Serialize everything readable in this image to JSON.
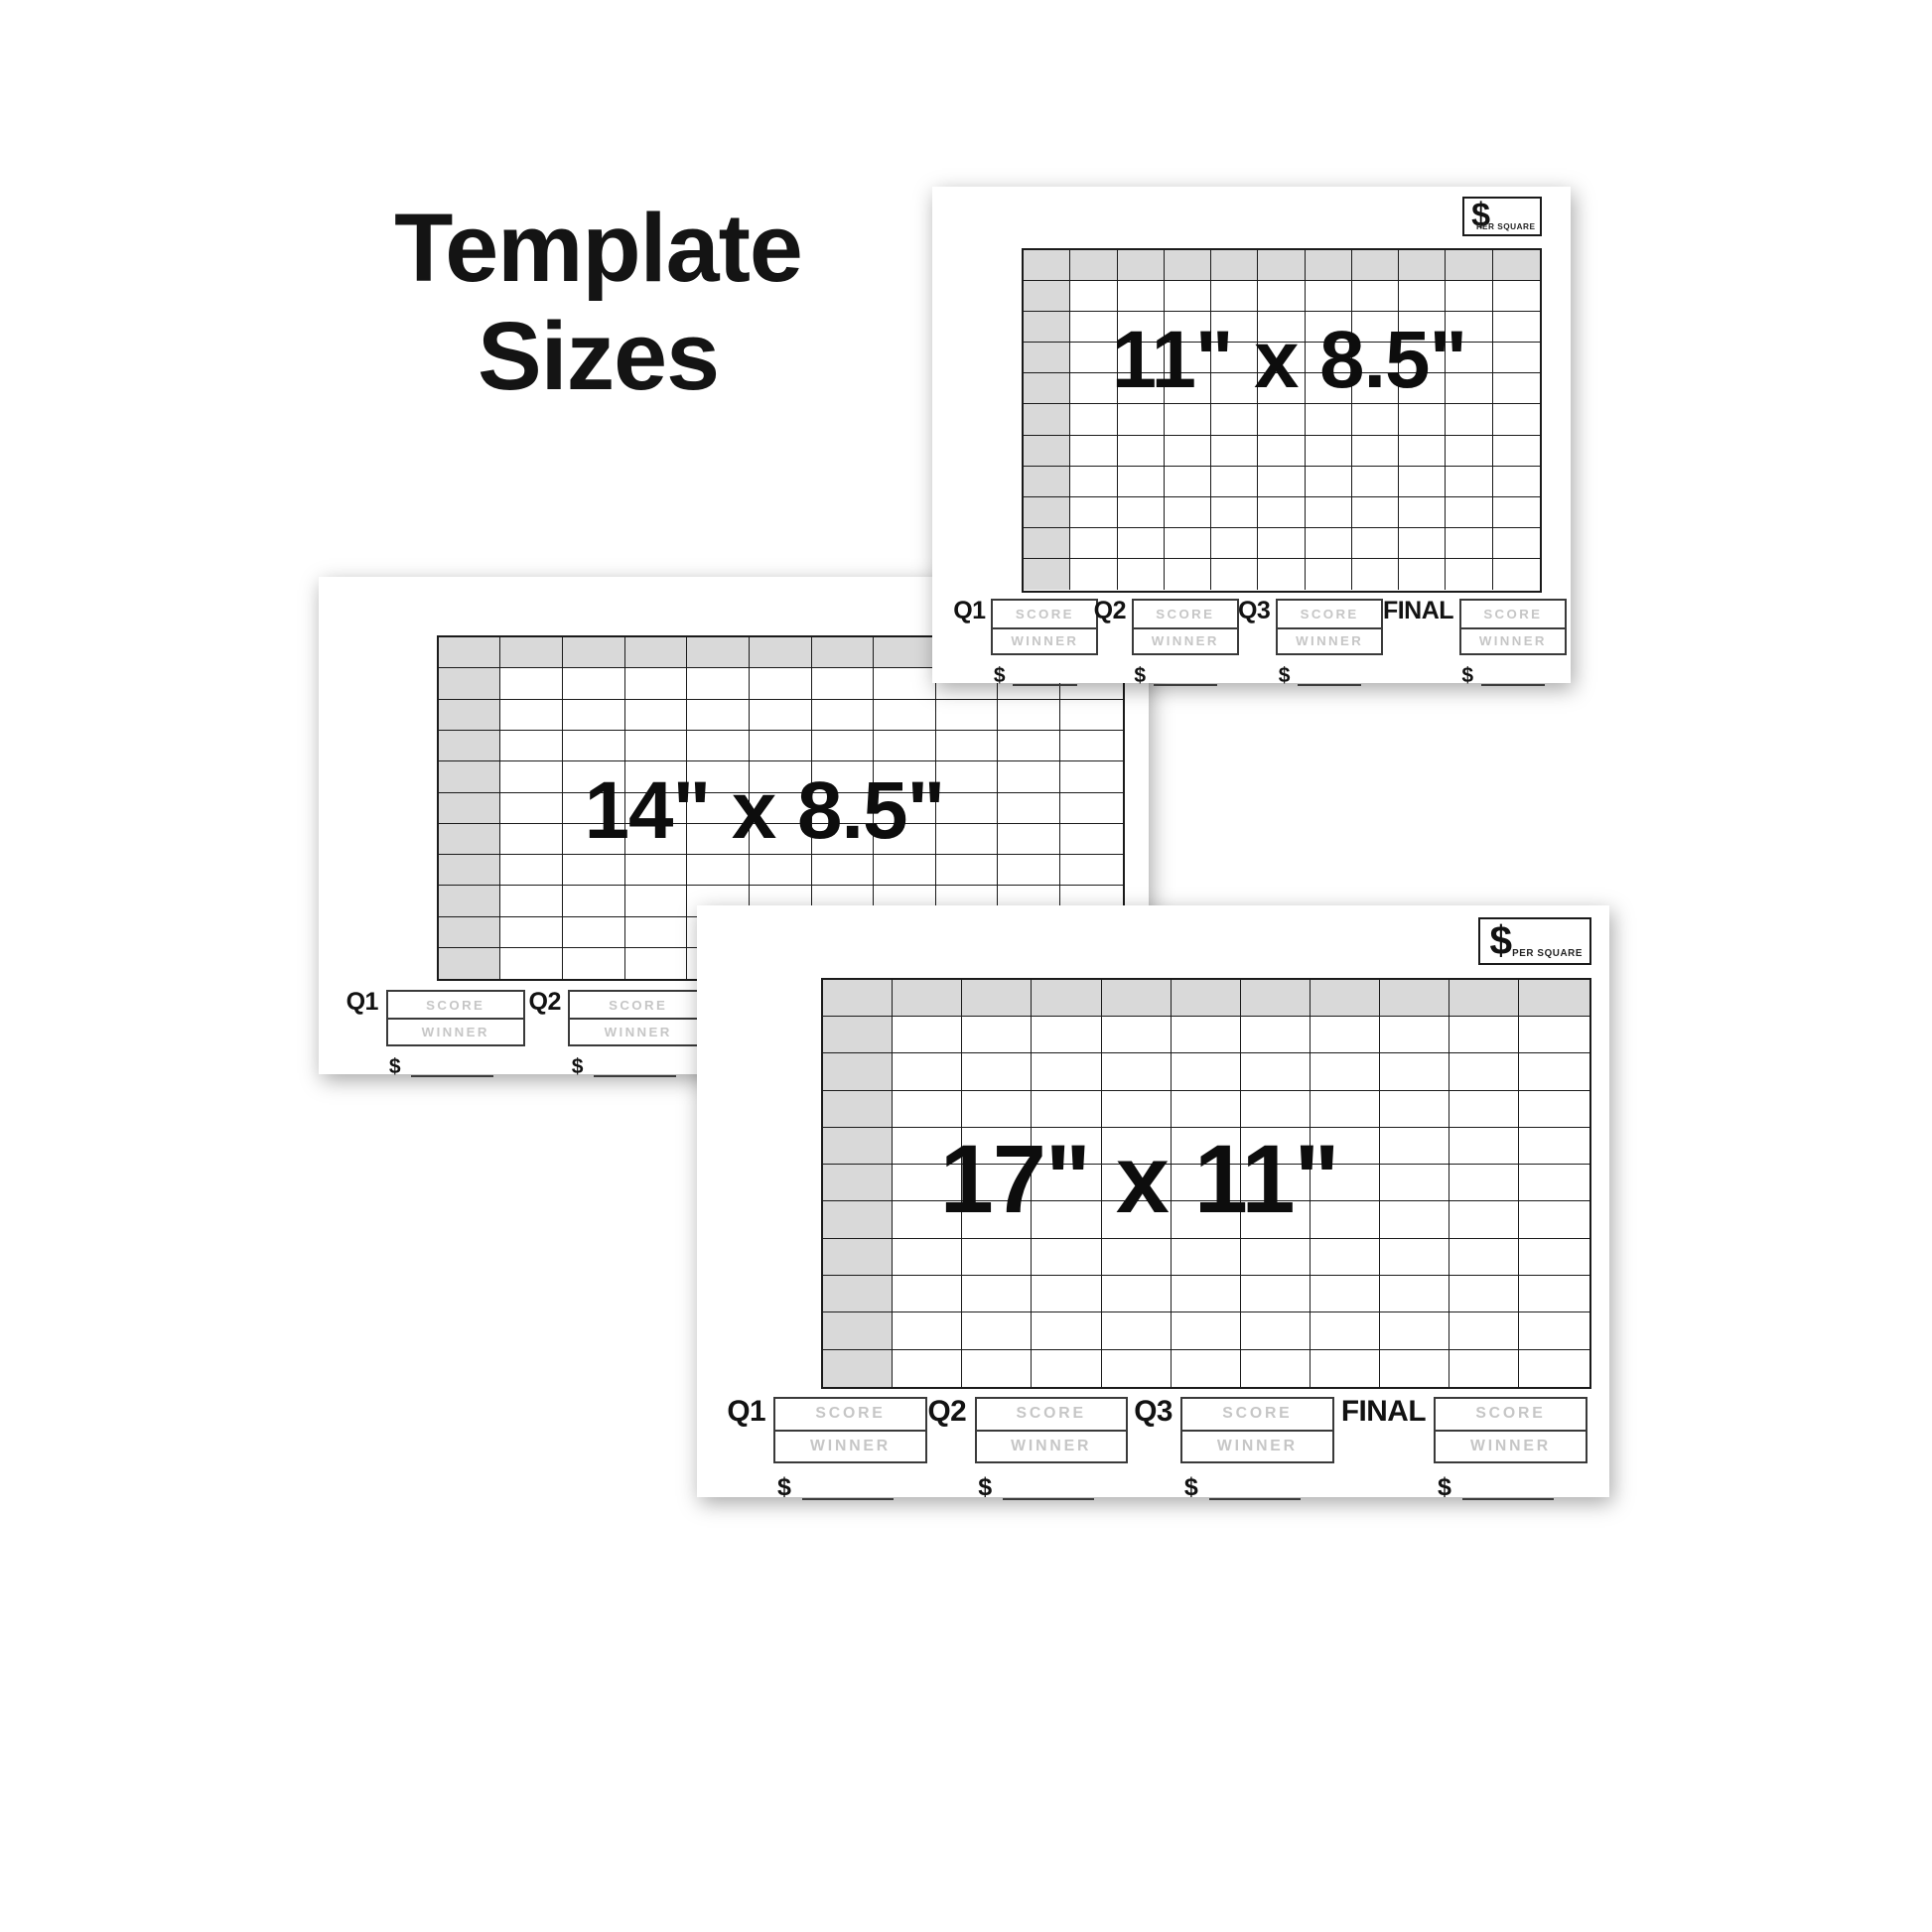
{
  "title": {
    "line1": "Template",
    "line2": "Sizes"
  },
  "colors": {
    "page_bg": "#ffffff",
    "card_bg": "#ffffff",
    "grid_line": "#1a1a1a",
    "header_cell": "#d9d9d9",
    "text": "#121212",
    "muted_text": "#c6c6c6",
    "line_color": "#3c3c3c"
  },
  "cards": [
    {
      "size_label": "11\" x 8.5\"",
      "price_box": {
        "dollar": "$",
        "caption": "PER SQUARE"
      },
      "grid": {
        "rows": 11,
        "cols": 11
      },
      "quarters": [
        {
          "label": "Q1",
          "score_label": "SCORE",
          "winner_label": "WINNER",
          "amount_prefix": "$"
        },
        {
          "label": "Q2",
          "score_label": "SCORE",
          "winner_label": "WINNER",
          "amount_prefix": "$"
        },
        {
          "label": "Q3",
          "score_label": "SCORE",
          "winner_label": "WINNER",
          "amount_prefix": "$"
        },
        {
          "label": "FINAL",
          "score_label": "SCORE",
          "winner_label": "WINNER",
          "amount_prefix": "$"
        }
      ]
    },
    {
      "size_label": "14\" x 8.5\"",
      "price_box": {
        "dollar": "$",
        "caption": "PER SQUARE"
      },
      "grid": {
        "rows": 11,
        "cols": 11
      },
      "quarters": [
        {
          "label": "Q1",
          "score_label": "SCORE",
          "winner_label": "WINNER",
          "amount_prefix": "$"
        },
        {
          "label": "Q2",
          "score_label": "SCORE",
          "winner_label": "WINNER",
          "amount_prefix": "$"
        },
        {
          "label": "Q3",
          "score_label": "SCORE",
          "winner_label": "WINNER",
          "amount_prefix": "$"
        },
        {
          "label": "FINAL",
          "score_label": "SCORE",
          "winner_label": "WINNER",
          "amount_prefix": "$"
        }
      ]
    },
    {
      "size_label": "17\" x 11\"",
      "price_box": {
        "dollar": "$",
        "caption": "PER SQUARE"
      },
      "grid": {
        "rows": 11,
        "cols": 11
      },
      "quarters": [
        {
          "label": "Q1",
          "score_label": "SCORE",
          "winner_label": "WINNER",
          "amount_prefix": "$"
        },
        {
          "label": "Q2",
          "score_label": "SCORE",
          "winner_label": "WINNER",
          "amount_prefix": "$"
        },
        {
          "label": "Q3",
          "score_label": "SCORE",
          "winner_label": "WINNER",
          "amount_prefix": "$"
        },
        {
          "label": "FINAL",
          "score_label": "SCORE",
          "winner_label": "WINNER",
          "amount_prefix": "$"
        }
      ]
    }
  ]
}
